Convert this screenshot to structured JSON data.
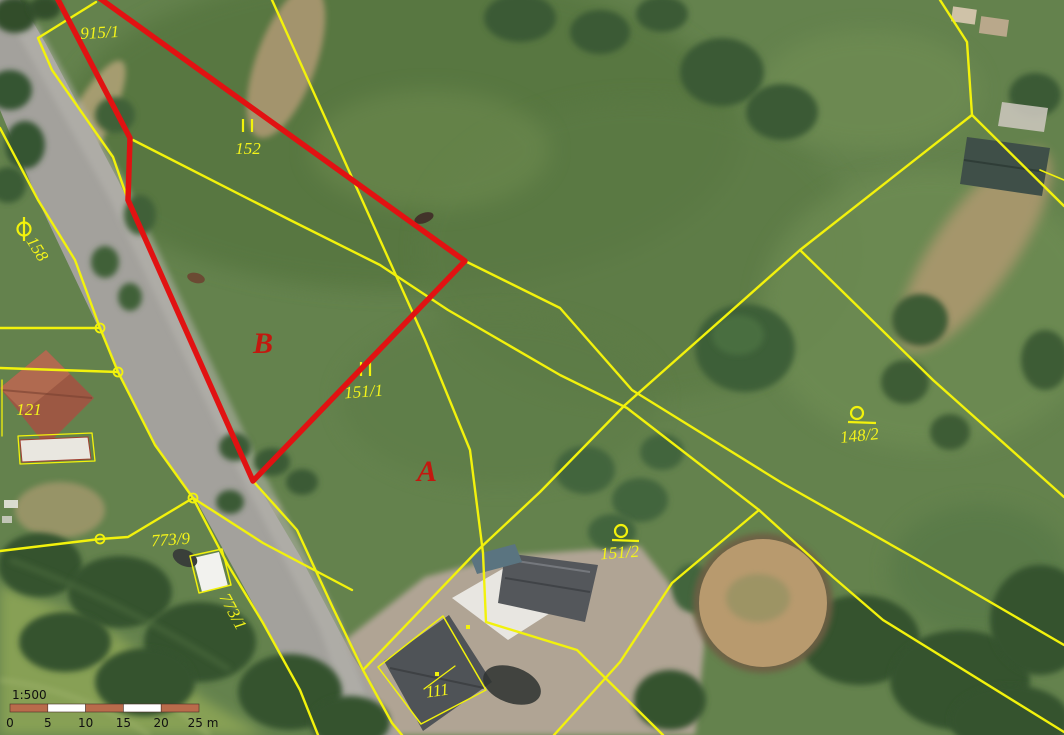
{
  "map": {
    "title": "cadastral-orthophoto-view",
    "colors": {
      "parcel_line_yellow": "#f2f20c",
      "highlight_red": "#e11212",
      "label_yellow": "#f4f41a",
      "label_red": "#c3180f",
      "scalebar_brown": "#b96b4b",
      "scalebar_white": "#ffffff"
    },
    "parcel_labels": [
      {
        "text": "915/1"
      },
      {
        "text": "152"
      },
      {
        "text": "158"
      },
      {
        "text": "121"
      },
      {
        "text": "773/9"
      },
      {
        "text": "773/1"
      },
      {
        "text": "111"
      },
      {
        "text": "151/1"
      },
      {
        "text": "151/2"
      },
      {
        "text": "148/2"
      }
    ],
    "zone_letters": [
      {
        "text": "B"
      },
      {
        "text": "A"
      }
    ],
    "symbols": [
      {
        "name": "built-up-area-symbol"
      },
      {
        "name": "meadow-symbol-II"
      },
      {
        "name": "meadow-symbol-II"
      },
      {
        "name": "garden-symbol-circle-tail"
      },
      {
        "name": "garden-symbol-circle-tail"
      },
      {
        "name": "boundary-point-circle"
      },
      {
        "name": "boundary-point-circle"
      },
      {
        "name": "boundary-point-circle"
      },
      {
        "name": "boundary-point-circle"
      }
    ],
    "scalebar": {
      "ratio": "1:500",
      "tick_labels": [
        "0",
        "5",
        "10",
        "15",
        "20",
        "25 m"
      ]
    }
  }
}
